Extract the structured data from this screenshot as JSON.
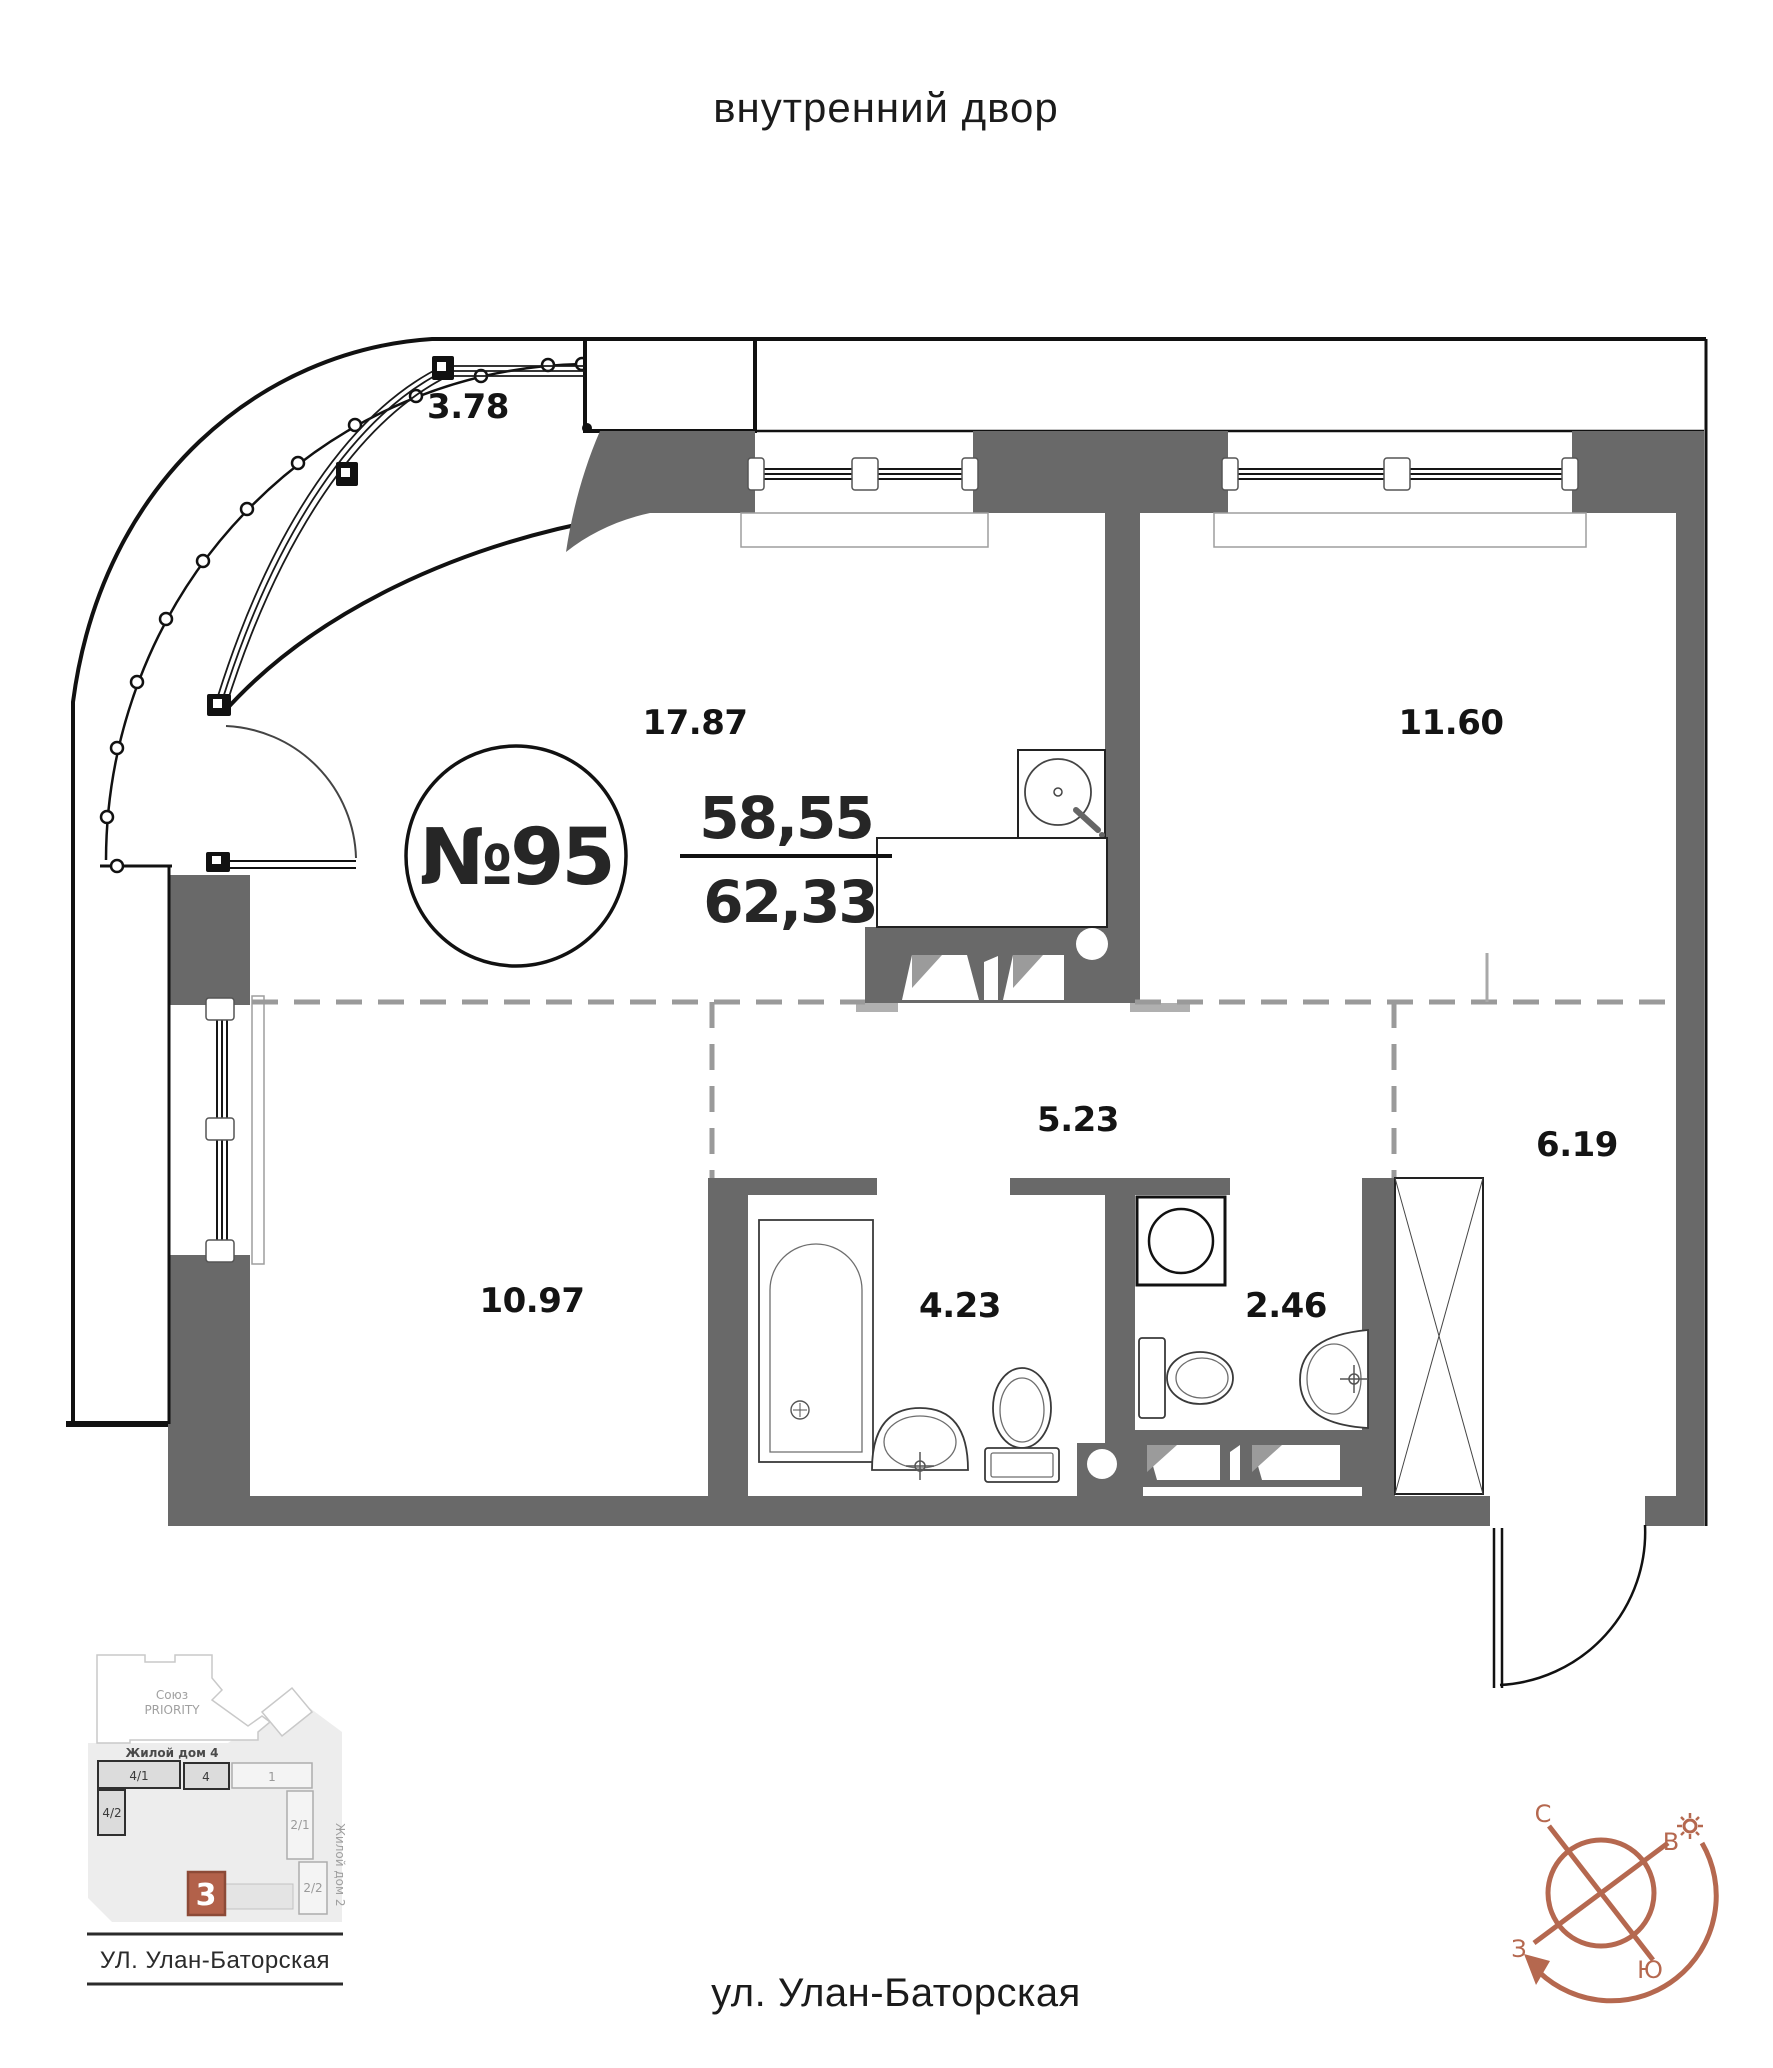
{
  "courtyard_label": "внутренний двор",
  "street_label": "ул. Улан-Баторская",
  "apartment": {
    "number": "№95",
    "living_area": "58,55",
    "total_area": "62,33"
  },
  "rooms": {
    "balcony": "3.78",
    "kitchen_living": "17.87",
    "bedroom": "11.60",
    "hallway": "5.23",
    "entry_hall": "6.19",
    "room": "10.97",
    "bathroom": "4.23",
    "wc": "2.46"
  },
  "site_plan": {
    "complex_line1": "Союз",
    "complex_line2": "PRIORITY",
    "building4": "Жилой дом 4",
    "building2": "Жилой дом 2",
    "block_41": "4/1",
    "block_4": "4",
    "block_1": "1",
    "block_42": "4/2",
    "block_21": "2/1",
    "block_22": "2/2",
    "current_building": "3",
    "street": "УЛ. Улан-Баторская"
  },
  "compass": {
    "north": "С",
    "east": "В",
    "west": "З",
    "south": "Ю"
  },
  "colors": {
    "wall": "#696969",
    "accent": "#b5684f",
    "dashed_line": "#9a9a9a"
  }
}
